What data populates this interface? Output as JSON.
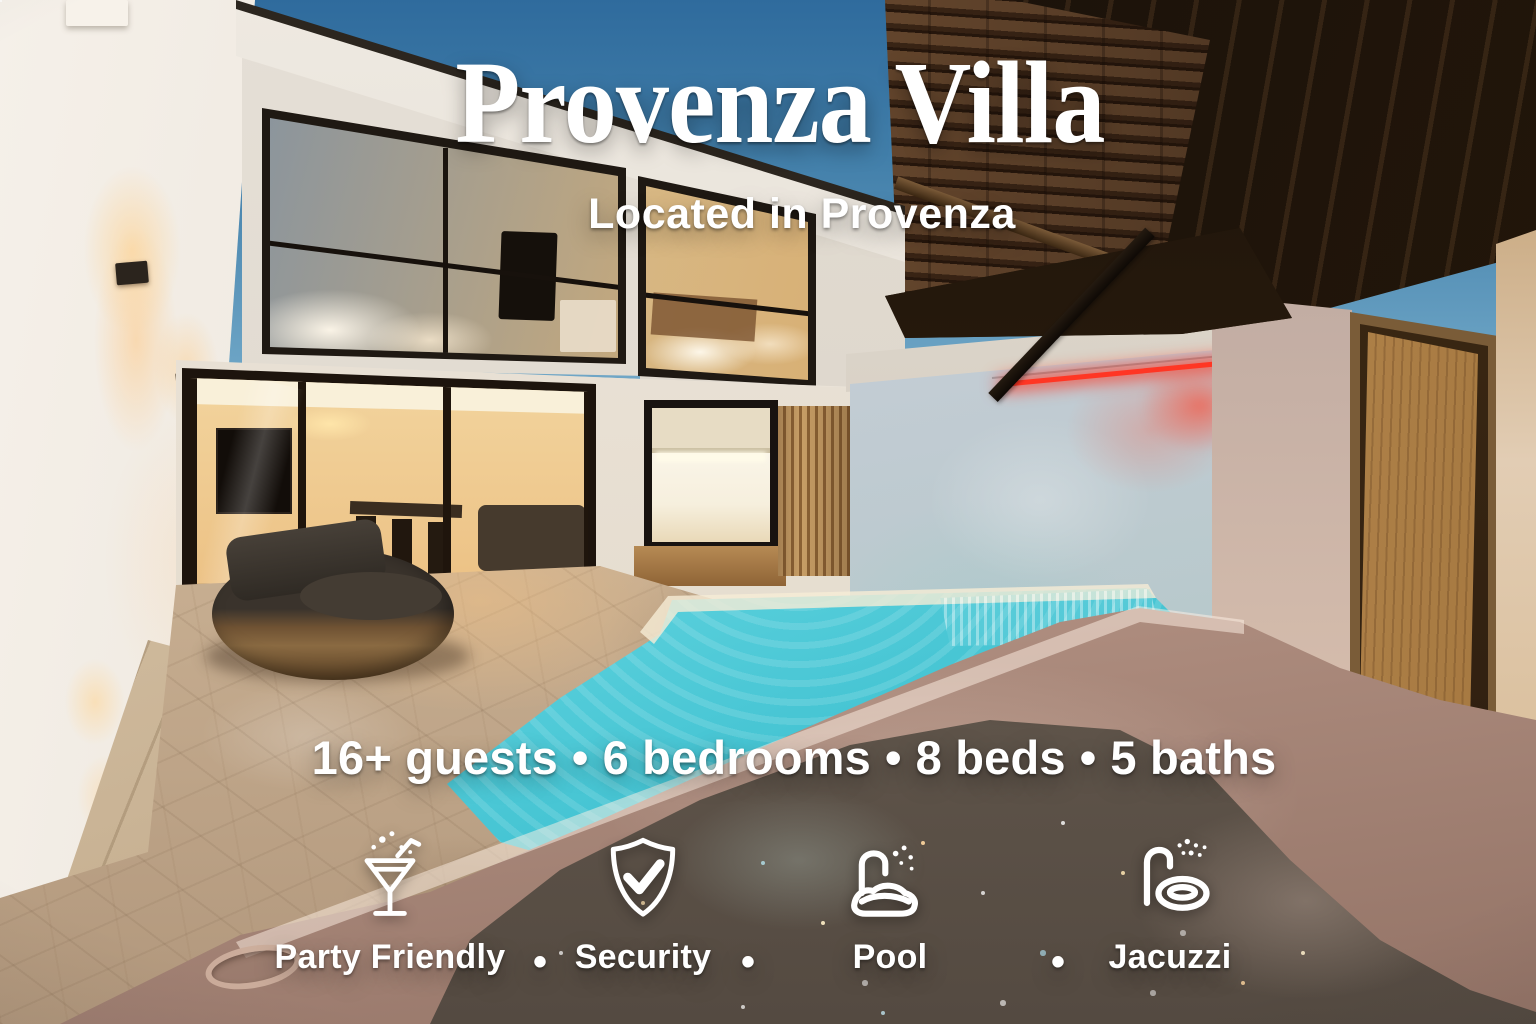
{
  "palette": {
    "text": "#ffffff",
    "sky_top": "#2f6b9d",
    "sky_light": "#a7cbd9",
    "pool_water": "#54cdd9",
    "led_strip": "#ff3624",
    "stone": "#cdb79c",
    "jacuzzi_rim": "#bd9d8f",
    "warm_interior": "#f5dca8",
    "wood": "#8a6134"
  },
  "overlay": {
    "title": "Provenza Villa",
    "subtitle": "Located in Provenza",
    "separator": "•",
    "stats": {
      "items": [
        "16+ guests",
        "6 bedrooms",
        "8 beds",
        "5 baths"
      ]
    },
    "amenities": {
      "items": [
        {
          "label": "Party Friendly",
          "icon": "martini-icon"
        },
        {
          "label": "Security",
          "icon": "shield-check-icon"
        },
        {
          "label": "Pool",
          "icon": "pool-shower-icon"
        },
        {
          "label": "Jacuzzi",
          "icon": "jacuzzi-tub-icon"
        }
      ]
    }
  }
}
